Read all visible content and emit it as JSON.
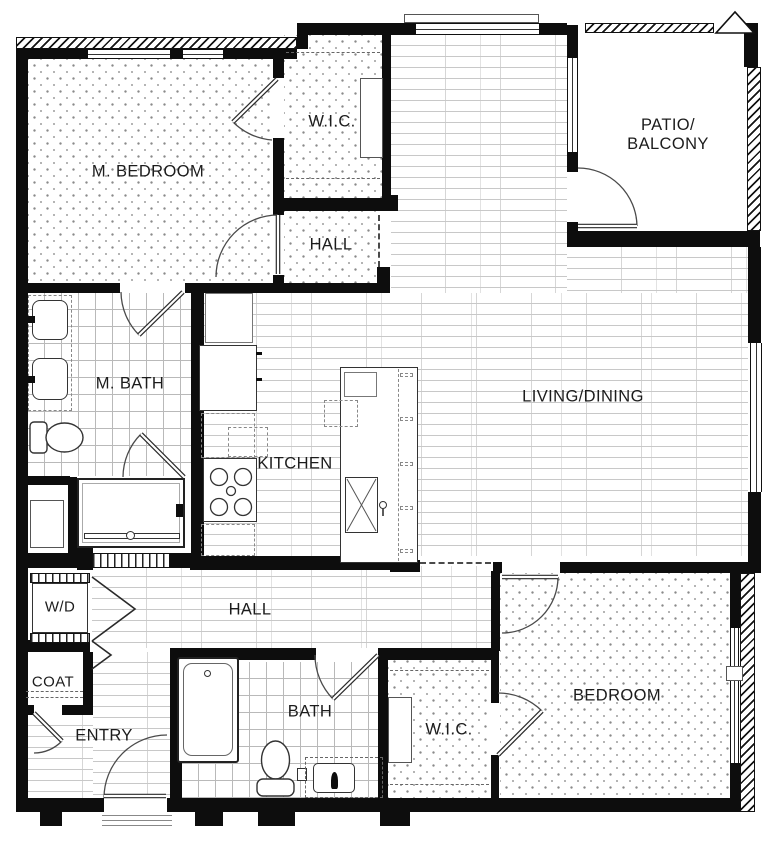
{
  "plan": {
    "labels": [
      {
        "id": "m_bedroom",
        "text": "M. BEDROOM"
      },
      {
        "id": "wic_top",
        "text": "W.I.C."
      },
      {
        "id": "patio",
        "text": "PATIO/\nBALCONY"
      },
      {
        "id": "hall_top",
        "text": "HALL"
      },
      {
        "id": "living",
        "text": "LIVING/DINING"
      },
      {
        "id": "m_bath",
        "text": "M. BATH"
      },
      {
        "id": "kitchen",
        "text": "KITCHEN"
      },
      {
        "id": "wd",
        "text": "W/D"
      },
      {
        "id": "hall_bottom",
        "text": "HALL"
      },
      {
        "id": "coat",
        "text": "COAT"
      },
      {
        "id": "entry",
        "text": "ENTRY"
      },
      {
        "id": "bath",
        "text": "BATH"
      },
      {
        "id": "wic_bottom",
        "text": "W.I.C."
      },
      {
        "id": "bedroom",
        "text": "BEDROOM"
      }
    ],
    "colors": {
      "wall": "#0d0d0d",
      "line": "#444444",
      "texture_line": "#c8c8c8",
      "background": "#ffffff"
    }
  }
}
